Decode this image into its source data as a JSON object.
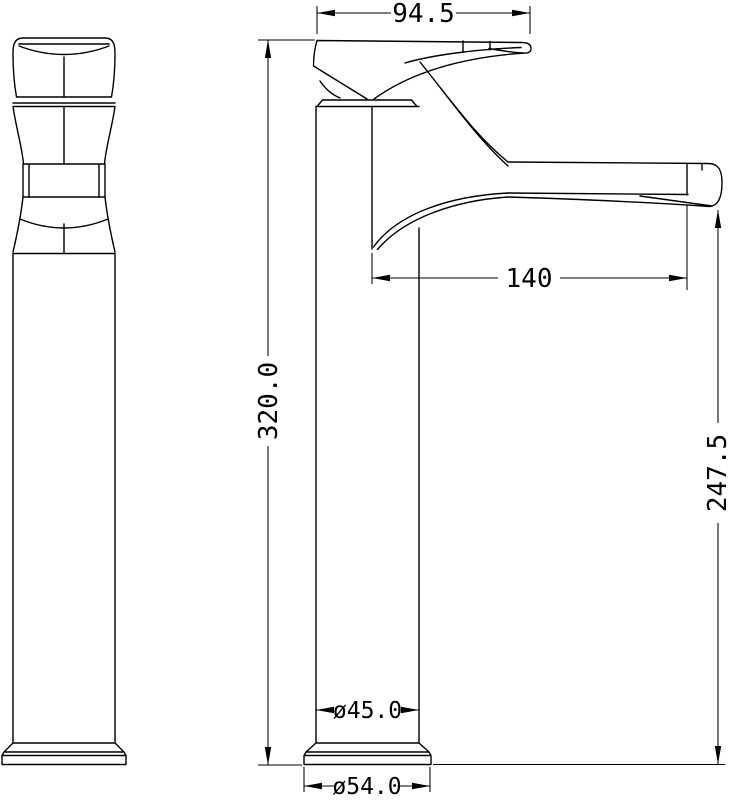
{
  "drawing": {
    "background_color": "#ffffff",
    "line_color": "#000000",
    "dimensions": {
      "handle_length": "94.5",
      "spout_reach": "140",
      "overall_height": "320.0",
      "spout_height": "247.5",
      "body_diameter": "ø45.0",
      "base_diameter": "ø54.0"
    }
  }
}
